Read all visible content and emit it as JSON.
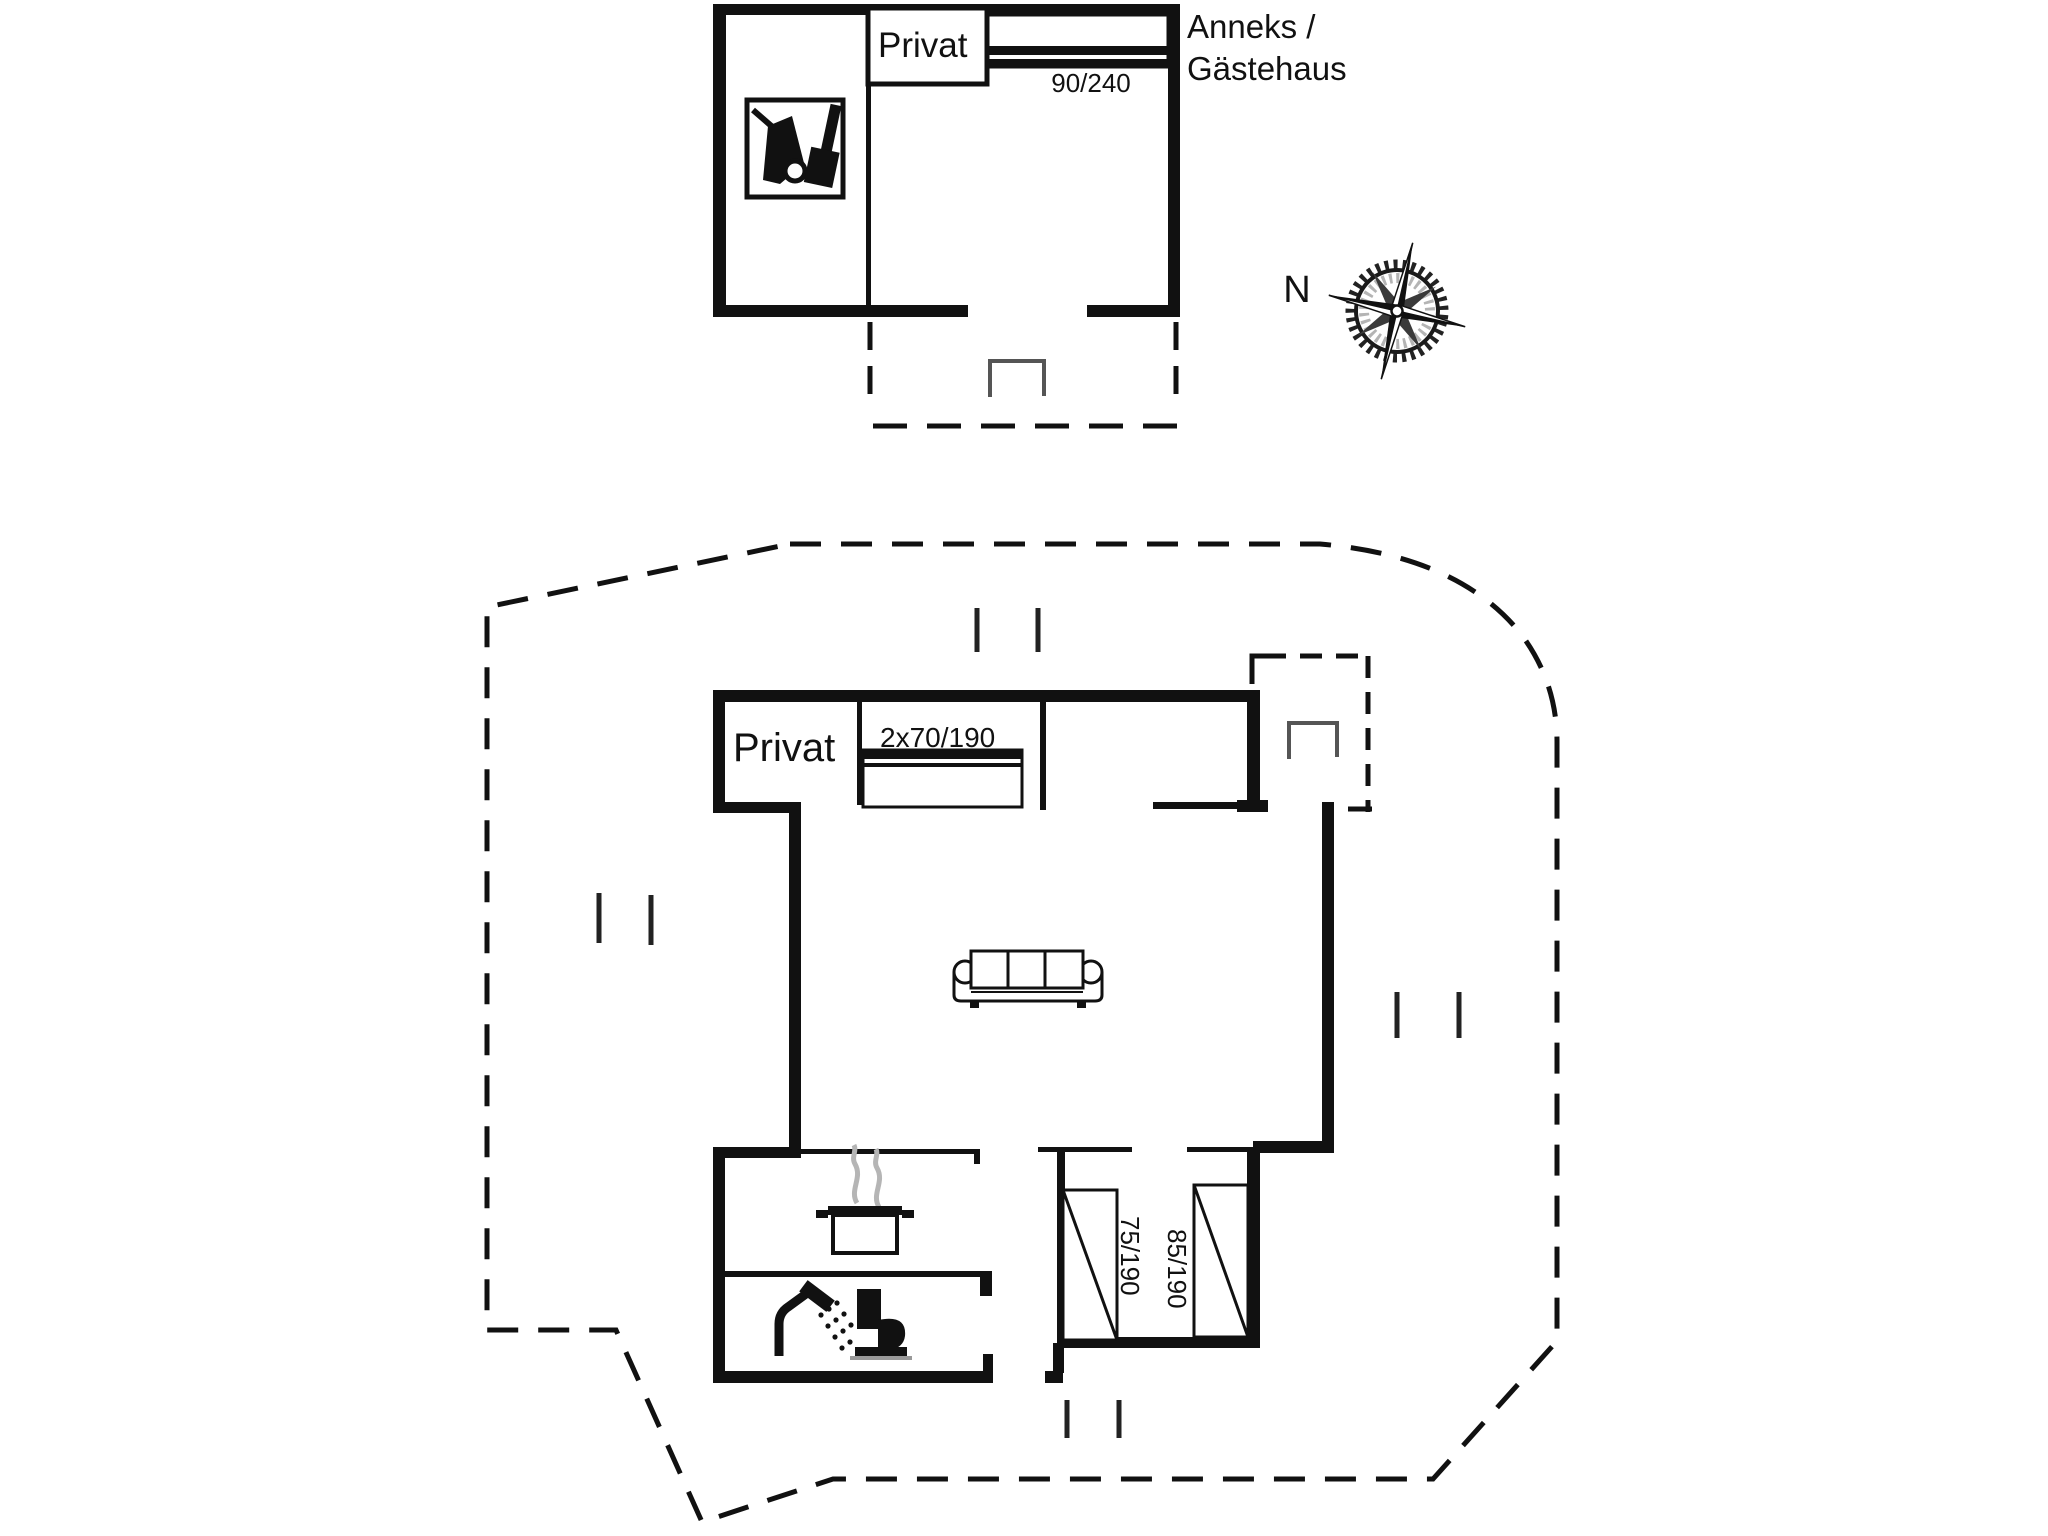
{
  "annex": {
    "room_label": "Privat",
    "bed_size_label": "90/240",
    "title_line1": "Anneks /",
    "title_line2": "Gästehaus"
  },
  "main_house": {
    "room_label": "Privat",
    "double_bed_label": "2x70/190",
    "single_bed_left_label": "75/190",
    "single_bed_right_label": "85/190"
  },
  "compass": {
    "north_label": "N"
  },
  "colors": {
    "wall": "#111111",
    "steam": "#b5b5b5",
    "door_swing": "#555555",
    "boundary_dash": "#111111",
    "background": "#ffffff"
  },
  "icons": [
    {
      "name": "vacuum-cleaner-icon",
      "meaning": "utility / cleaning room in annex"
    },
    {
      "name": "cooking-pot-icon",
      "meaning": "kitchen stove"
    },
    {
      "name": "steam-icon",
      "meaning": "cooking steam"
    },
    {
      "name": "shower-icon",
      "meaning": "bathroom shower"
    },
    {
      "name": "toilet-icon",
      "meaning": "bathroom toilet"
    },
    {
      "name": "sofa-icon",
      "meaning": "living room sofa"
    },
    {
      "name": "compass-rose-icon",
      "meaning": "map orientation"
    },
    {
      "name": "door-swing-icon",
      "meaning": "entrance door swing"
    }
  ]
}
